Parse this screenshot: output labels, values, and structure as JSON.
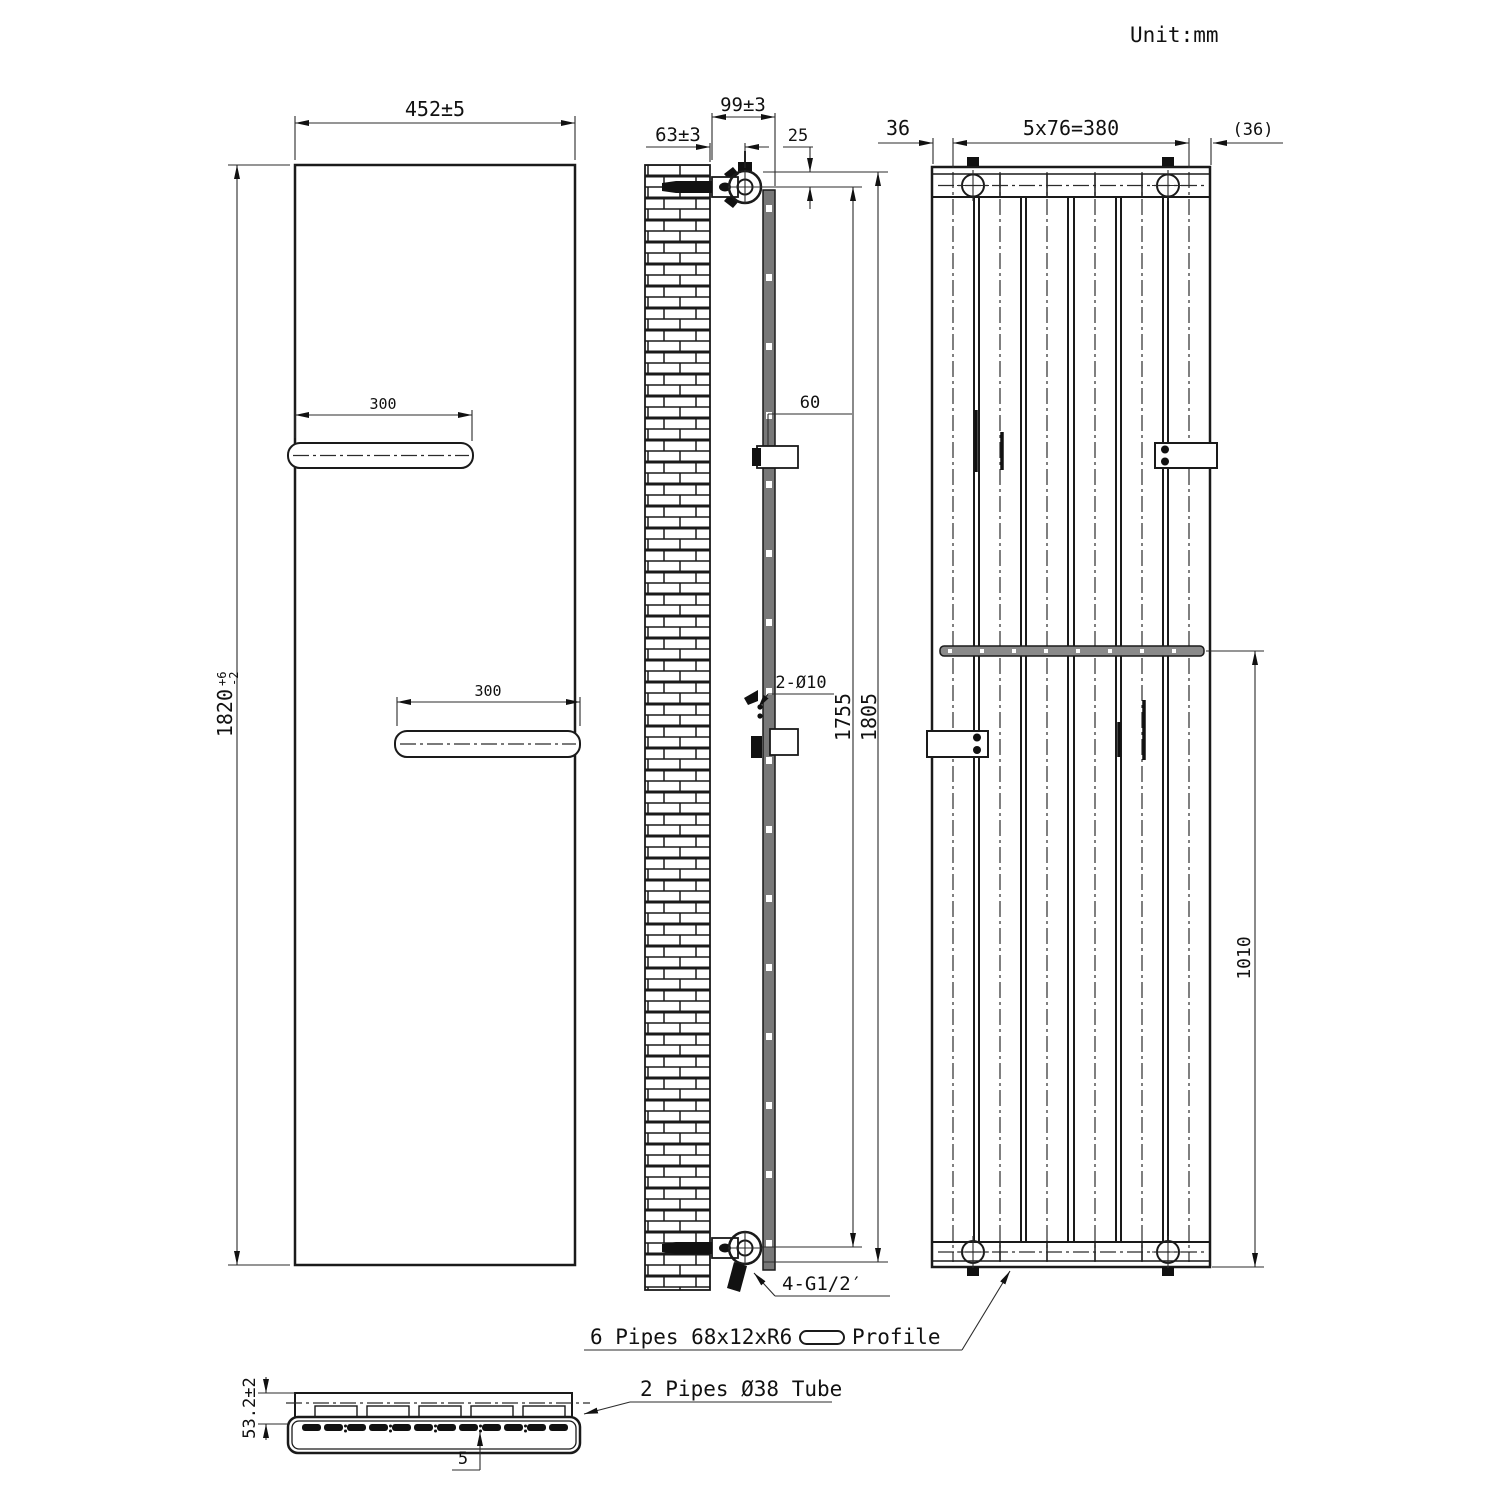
{
  "meta": {
    "unit_label": "Unit:mm"
  },
  "front": {
    "width_dim": "452±5",
    "height_dim": "1820",
    "height_tol_plus": "+6",
    "height_tol_minus": "-2",
    "shelf_top_dim": "300",
    "shelf_bottom_dim": "300"
  },
  "side": {
    "wall_to_valve_dim": "63±3",
    "wall_to_front_dim": "99±3",
    "valve_offset_dim": "25",
    "bracket_dim": "60",
    "holes_note": "2-Ø10",
    "pipe_centers_dim": "1755",
    "overall_height_dim": "1805",
    "connections_note": "4-G1/2′"
  },
  "rear": {
    "edge_left_dim": "36",
    "pipe_pitch_dim": "5x76=380",
    "edge_right_dim": "(36)",
    "bracket_span_dim": "1010"
  },
  "section": {
    "depth_dim": "53.2±2",
    "gap_dim": "5"
  },
  "notes": {
    "profile_note": "6 Pipes 68x12xR6",
    "profile_label": "Profile",
    "tube_note": "2 Pipes Ø38 Tube"
  }
}
